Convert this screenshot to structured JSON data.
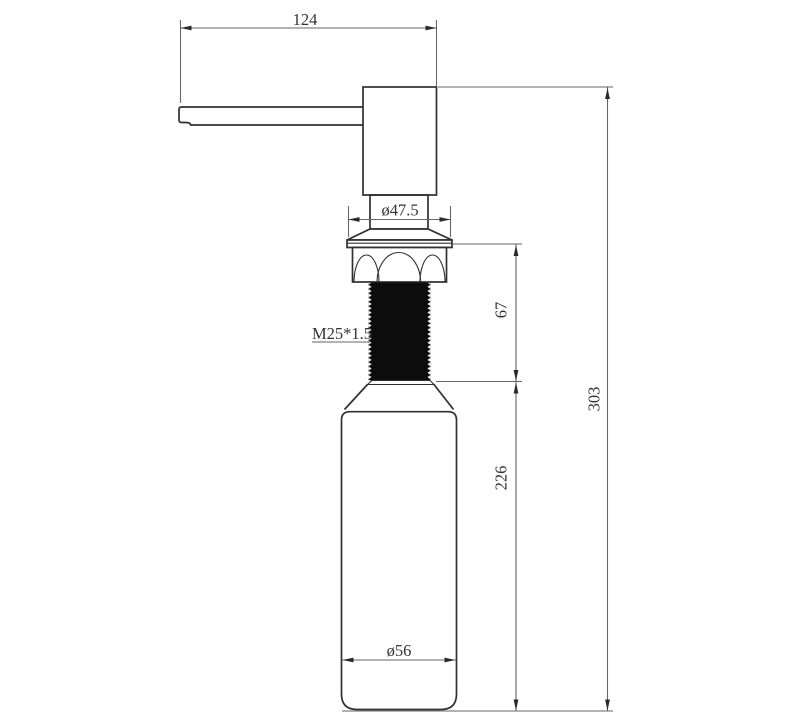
{
  "drawing": {
    "type": "technical-dimension-drawing",
    "subject": "soap-dispenser-pump-with-bottle",
    "labels": {
      "spout_length": "124",
      "flange_diameter": "ø47.5",
      "thread_spec": "M25*1.5",
      "thread_section_height": "67",
      "bottle_section_height": "226",
      "overall_height": "303",
      "bottle_diameter": "ø56"
    },
    "colors": {
      "background": "#ffffff",
      "outline": "#303030",
      "dimension": "#666666",
      "arrow": "#2a2a2a",
      "text_color": "#333333",
      "thread_fill": "#0c0c0c"
    }
  }
}
